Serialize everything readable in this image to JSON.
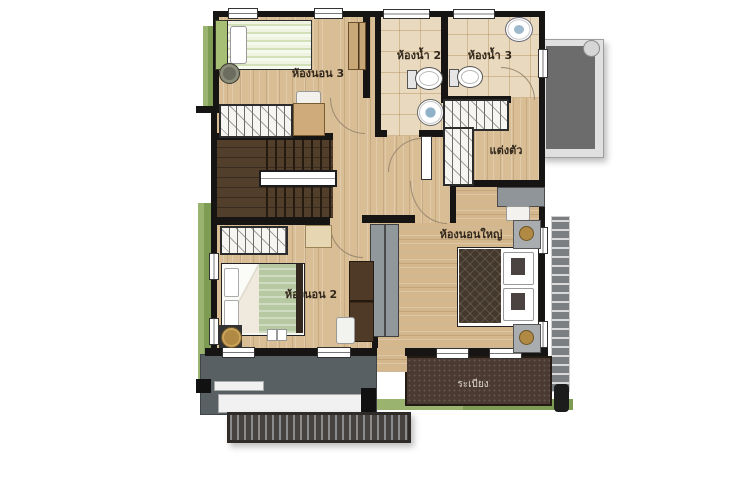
{
  "rooms": {
    "bedroom3": {
      "label": "ห้องนอน 3"
    },
    "bathroom2": {
      "label": "ห้องน้ำ 2"
    },
    "bathroom3": {
      "label": "ห้องน้ำ 3"
    },
    "dressing": {
      "label": "แต่งตัว"
    },
    "master_bedroom": {
      "label": "ห้องนอนใหญ่"
    },
    "bedroom2": {
      "label": "ห้องนอน 2"
    },
    "balcony": {
      "label": "ระเบียง"
    }
  },
  "palette": {
    "wall": "#171513",
    "wood_floor": "#d8bd95",
    "tile_floor": "#e9dabf",
    "stair_wood": "#513e2b",
    "deck_brown": "#4a3a31",
    "planter_green": "#8fac63",
    "roof_gray": "#6c6c6c",
    "lower_roof_gray": "#596064",
    "awning_dark": "#3f3b38",
    "bed_green": "#b7c9a2",
    "lamp_bronze": "#b08a44"
  }
}
